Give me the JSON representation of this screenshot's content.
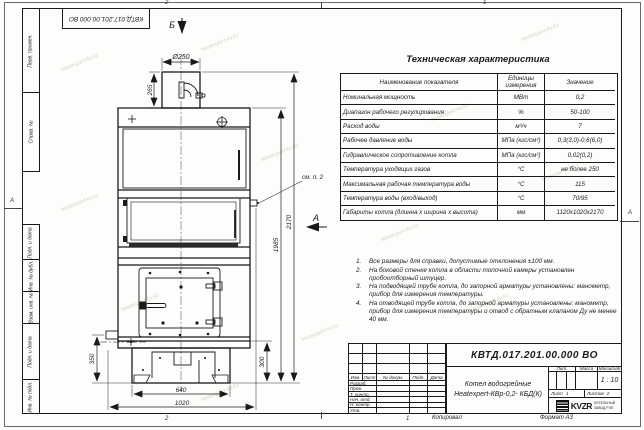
{
  "sheet": {
    "copied_label": "Копировал",
    "format_label": "Формат А3",
    "zones": {
      "top_left": "2",
      "top_right": "1",
      "bottom_left": "2",
      "bottom_right": "1",
      "side_left": "А",
      "side_right": "А"
    },
    "side_columns": [
      "Перв. примен.",
      "Справ. №",
      "Подп. и дата",
      "Инв. № дубл.",
      "Взам. инв. №",
      "Подп. и дата",
      "Инв. № подл."
    ]
  },
  "watermark": {
    "text": "heatexpert-kv.kz"
  },
  "drawing": {
    "view_top": "Б",
    "view_side": "А",
    "see_note": "см. п. 2",
    "dims": {
      "chimney_dia": "Ø250",
      "chimney_h": "265",
      "total_h": "2170",
      "body_h": "1985",
      "left_h": "350",
      "right_h": "300",
      "base_w": "640",
      "total_w": "1020"
    }
  },
  "spec_table": {
    "title": "Техническая характеристика",
    "headers": [
      "Наименование показателя",
      "Единицы измерения",
      "Значение"
    ],
    "rows": [
      [
        "Номинальная мощность",
        "МВт",
        "0,2"
      ],
      [
        "Диапазон рабочего регулирования",
        "%",
        "50-100"
      ],
      [
        "Расход воды",
        "м³/ч",
        "7"
      ],
      [
        "Рабочее давление воды",
        "МПа (кгс/см²)",
        "0,3(3,0)-0,6(6,0)"
      ],
      [
        "Гидравлическое сопротивление котла",
        "МПа (кгс/см²)",
        "0,02(0,2)"
      ],
      [
        "Температура уходящих газов",
        "°С",
        "не более 250"
      ],
      [
        "Максимальная рабочая температура воды",
        "°С",
        "115"
      ],
      [
        "Температура воды (вход/выход)",
        "°С",
        "70/95"
      ],
      [
        "Габариты котла (длинна х ширина х высота)",
        "мм",
        "1120х1020х2170"
      ]
    ]
  },
  "notes": [
    {
      "num": "1.",
      "text": "Все размеры для справки, допустимые отклонения ±100 мм."
    },
    {
      "num": "2.",
      "text": "На боковой стенке котла в области топочной камеры установлен пробоотборный штуцер."
    },
    {
      "num": "3.",
      "text": "На подводящей трубе котла, до запорной арматуры установлены: манометр, прибор для измерения температуры."
    },
    {
      "num": "4.",
      "text": "На отводящей трубе котла, до запорной арматуры установлены: манометр, прибор для измерения температуры и отвод с обратным клапаном Ду не менее 40 мм."
    }
  ],
  "title_block": {
    "doc_number": "КВТД.017.201.00.000 ВО",
    "product_line1": "Котел водогрейные",
    "product_line2": "Heatexpert-КВр-0,2- КБД(К)",
    "col_izm": "Изм.",
    "col_list": "Лист",
    "col_docum": "№ докум.",
    "col_podp": "Подп.",
    "col_data": "Дата",
    "row_razrab": "Разраб.",
    "row_prov": "Пров.",
    "row_tkontr": "Т. контр.",
    "row_nachotd": "Нач. отд.",
    "row_nkontr": "Н. контр.",
    "row_utv": "Утв.",
    "lit_label": "Лит.",
    "massa_label": "Масса",
    "masshtab_label": "Масштаб",
    "scale_value": "1 : 10",
    "sheet_label": "Лист",
    "sheet_value": "1",
    "sheets_label": "Листов",
    "sheets_value": "2",
    "logo_word": "KVZR",
    "company_line1": "КОТЕЛЬНЫЙ",
    "company_line2": "ЗАВОД РЭП"
  }
}
